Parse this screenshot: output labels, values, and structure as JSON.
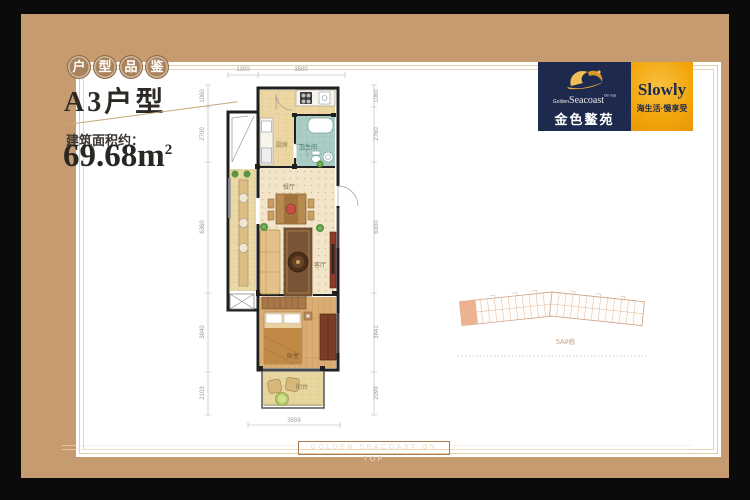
{
  "badges": {
    "chars": [
      "户",
      "型",
      "品",
      "鉴"
    ]
  },
  "header": {
    "unit_title": "A3户型",
    "area_label": "建筑面积约：",
    "area_value": "69.68m",
    "area_sup": "2"
  },
  "logo": {
    "golden": "Golden",
    "seacoast": "Seacoast",
    "on_top": "On top",
    "cn_name": "金色鳌苑",
    "slogan_en": "Slowly",
    "slogan_cn": "海生活·慢享受"
  },
  "floorplan": {
    "rooms": {
      "kitchen": "厨房",
      "bath": "卫生间",
      "dining": "餐厅",
      "living": "客厅",
      "bedroom": "卧室",
      "balcony": "阳台"
    },
    "dims": {
      "top_left": "1300",
      "top_right": "3500",
      "bottom": "3559",
      "left": [
        "1060",
        "2700",
        "6360",
        "3840",
        "2103"
      ],
      "right": [
        "1060",
        "2760",
        "6300",
        "3841",
        "2099"
      ]
    }
  },
  "siteplan": {
    "building_label": "5A#栋"
  },
  "footer": {
    "band_text": "GOLDEN SEACOAST ON TOP"
  },
  "colors": {
    "frame_tan": "#c79b70",
    "navy": "#1d2a4e",
    "gold": "#f2a50a",
    "badge": "#a9835c"
  }
}
